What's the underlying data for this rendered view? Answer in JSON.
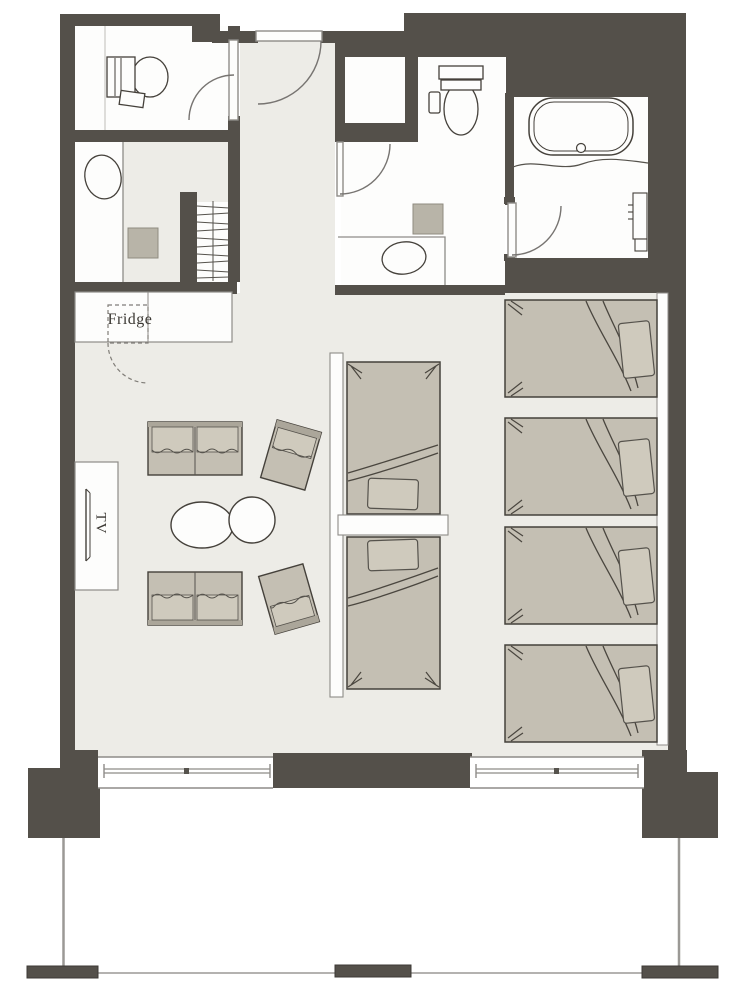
{
  "labels": {
    "fridge": "Fridge",
    "tv": "TV"
  },
  "colors": {
    "wall": "#54504a",
    "floor": "#edece7",
    "room_floor": "#fdfdfc",
    "furniture": "#c4bfb3",
    "furniture_light": "#cfcabd",
    "accent_square": "#b8b4a8",
    "outline_dark": "#45413b",
    "outline_mid": "#8e8c88"
  },
  "furniture_icons": [
    "toilet-icon",
    "washbasin-icon",
    "luggage-rack-icon",
    "fridge-icon",
    "tv-icon",
    "sofa-icon",
    "lounge-chair-icon",
    "coffee-table-icon",
    "bed-icon",
    "pillow-icon",
    "bathtub-icon",
    "door-swing-icon",
    "window-icon",
    "balcony-rail-icon"
  ]
}
